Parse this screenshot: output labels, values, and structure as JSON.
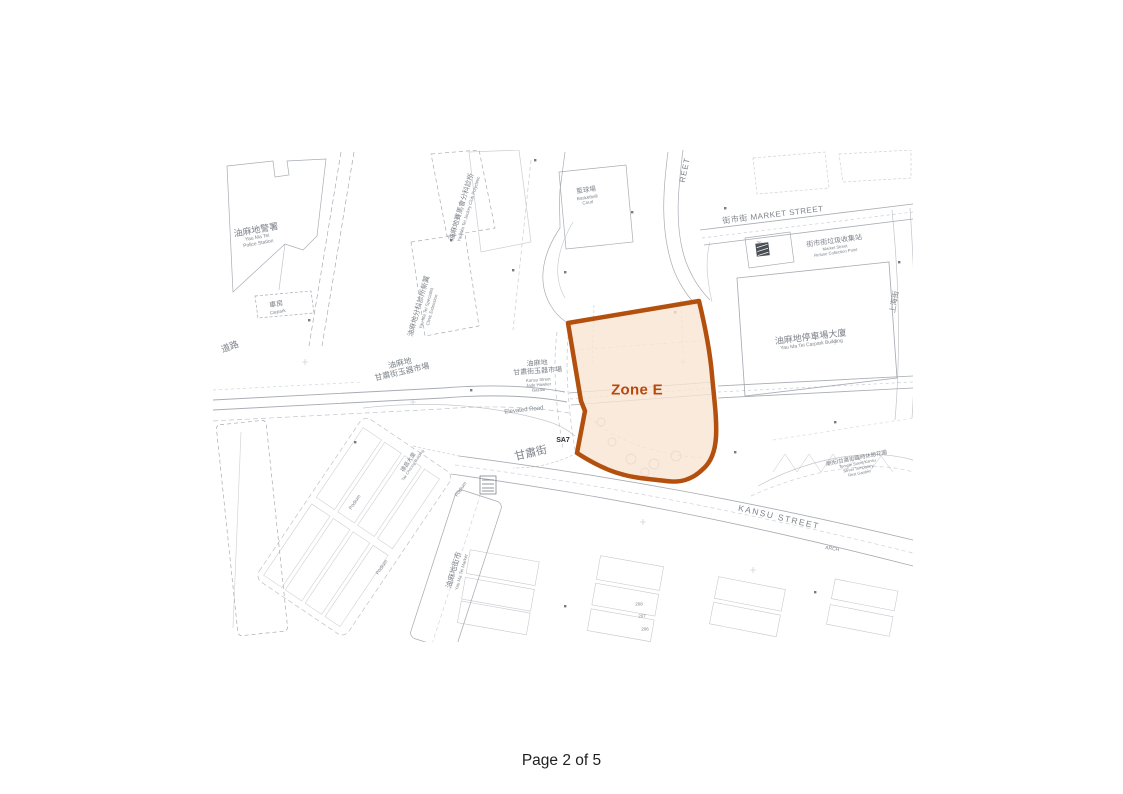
{
  "document": {
    "footer": "Page 2 of 5"
  },
  "map": {
    "zone": {
      "label": "Zone E",
      "fill": "#F7E4D2",
      "fill_opacity": 0.78,
      "border": "#B3500E",
      "label_color": "#B8490B",
      "label_x": 424,
      "label_y": 240
    },
    "ink": "#989da6",
    "labels": [
      {
        "id": "yau-ma-tei-police-station",
        "x": 44,
        "y": 86,
        "rot": -10,
        "lines": [
          {
            "t": "油麻地警署",
            "s": 9
          },
          {
            "t": "Yau Ma Tei",
            "s": 5
          },
          {
            "t": "Police Station",
            "s": 5
          }
        ]
      },
      {
        "id": "garage",
        "x": 64,
        "y": 158,
        "rot": -10,
        "lines": [
          {
            "t": "車房",
            "s": 7
          },
          {
            "t": "Carpark",
            "s": 4.5
          }
        ]
      },
      {
        "id": "road-name-partial",
        "x": 17,
        "y": 197,
        "rot": -20,
        "lines": [
          {
            "t": "道路",
            "s": 9
          }
        ]
      },
      {
        "id": "specialist-clinic-extension",
        "x": 212,
        "y": 158,
        "rot": -74,
        "lines": [
          {
            "t": "油麻地分科診所新翼",
            "s": 7
          },
          {
            "t": "Yau Ma Tei Specialist",
            "s": 4.5
          },
          {
            "t": "Clinic Extension",
            "s": 4.5
          }
        ]
      },
      {
        "id": "jockey-club-polyclinic",
        "x": 252,
        "y": 58,
        "rot": -73,
        "lines": [
          {
            "t": "油麻地賽馬會分科診所",
            "s": 7
          },
          {
            "t": "Yau Ma Tei Jockey Club Polyclinic",
            "s": 4.5
          }
        ]
      },
      {
        "id": "basketball-court",
        "x": 374,
        "y": 46,
        "rot": -8,
        "lines": [
          {
            "t": "籃球場",
            "s": 6.5
          },
          {
            "t": "Basketball",
            "s": 4.5
          },
          {
            "t": "Court",
            "s": 4.5
          }
        ]
      },
      {
        "id": "street-name-partial",
        "x": 472,
        "y": 20,
        "rot": -78,
        "lines": [
          {
            "t": "REET",
            "s": 8,
            "ls": 1
          }
        ]
      },
      {
        "id": "market-street",
        "x": 560,
        "y": 65,
        "rot": -7,
        "lines": [
          {
            "t": "街市街  MARKET STREET",
            "s": 8,
            "ls": 0.5
          }
        ]
      },
      {
        "id": "refuse-collection-point",
        "x": 622,
        "y": 97,
        "rot": -8,
        "lines": [
          {
            "t": "街市街垃圾收集站",
            "s": 7
          },
          {
            "t": "Market Street",
            "s": 4.2
          },
          {
            "t": "Refuse Collection Point",
            "s": 4.2
          }
        ]
      },
      {
        "id": "number-70",
        "x": 546,
        "y": 93,
        "rot": 0,
        "lines": [
          {
            "t": "70",
            "s": 4.5
          }
        ]
      },
      {
        "id": "carpark-building",
        "x": 598,
        "y": 190,
        "rot": -7,
        "lines": [
          {
            "t": "油麻地停車場大廈",
            "s": 9
          },
          {
            "t": "Yau Ma Tei Carpark Building",
            "s": 5
          }
        ]
      },
      {
        "id": "shanghai-street",
        "x": 682,
        "y": 152,
        "rot": -80,
        "lines": [
          {
            "t": "上海街",
            "s": 7.5
          }
        ]
      },
      {
        "id": "jade-market-cn",
        "x": 188,
        "y": 218,
        "rot": -13,
        "lines": [
          {
            "t": "油麻地",
            "s": 8
          },
          {
            "t": "甘肅街玉器市場",
            "s": 8
          }
        ]
      },
      {
        "id": "jade-hawker-bazaar",
        "x": 325,
        "y": 226,
        "rot": -4,
        "lines": [
          {
            "t": "油麻地",
            "s": 7
          },
          {
            "t": "甘肅街玉器市場",
            "s": 7
          },
          {
            "t": "Kansu Street",
            "s": 4.3
          },
          {
            "t": "Jade Hawker",
            "s": 4.3
          },
          {
            "t": "Bazaar",
            "s": 4.3
          }
        ]
      },
      {
        "id": "elevated-road",
        "x": 311,
        "y": 261,
        "rot": -6,
        "lines": [
          {
            "t": "Elevated Road",
            "s": 6
          }
        ]
      },
      {
        "id": "sa7-marker",
        "x": 350,
        "y": 291,
        "rot": 0,
        "lines": [
          {
            "t": "SA7",
            "s": 7,
            "b": true,
            "c": "#2a2d31"
          }
        ]
      },
      {
        "id": "kansu-street-cn",
        "x": 318,
        "y": 304,
        "rot": -13,
        "lines": [
          {
            "t": "甘肅街",
            "s": 11
          }
        ]
      },
      {
        "id": "kansu-street-en",
        "x": 566,
        "y": 367,
        "rot": 13,
        "lines": [
          {
            "t": "KANSU STREET",
            "s": 8.5,
            "ls": 1.5
          }
        ]
      },
      {
        "id": "rest-garden",
        "x": 645,
        "y": 316,
        "rot": -11,
        "lines": [
          {
            "t": "廟街/甘肅街臨時休憩花園",
            "s": 5.5
          },
          {
            "t": "Temple Street/Kansu",
            "s": 4
          },
          {
            "t": "Street Temporary",
            "s": 4
          },
          {
            "t": "Rest Garden",
            "s": 4
          }
        ]
      },
      {
        "id": "yau-ma-tei-market",
        "x": 244,
        "y": 421,
        "rot": -74,
        "lines": [
          {
            "t": "油麻地街市",
            "s": 7.5
          },
          {
            "t": "Yau Ma Tei Market",
            "s": 4.5
          }
        ]
      },
      {
        "id": "tak-cheong-building",
        "x": 198,
        "y": 314,
        "rot": -56,
        "lines": [
          {
            "t": "德昌大廈",
            "s": 5.5
          },
          {
            "t": "Tak Cheong Building",
            "s": 4
          }
        ]
      },
      {
        "id": "podium-1",
        "x": 143,
        "y": 353,
        "rot": -56,
        "lines": [
          {
            "t": "Podium",
            "s": 5
          }
        ]
      },
      {
        "id": "podium-2",
        "x": 170,
        "y": 418,
        "rot": -56,
        "lines": [
          {
            "t": "Podium",
            "s": 5
          }
        ]
      },
      {
        "id": "podium-3",
        "x": 249,
        "y": 340,
        "rot": -56,
        "lines": [
          {
            "t": "Podium",
            "s": 5
          }
        ]
      },
      {
        "id": "arch",
        "x": 619,
        "y": 400,
        "rot": 10,
        "lines": [
          {
            "t": "ARCH",
            "s": 5
          }
        ]
      },
      {
        "id": "number-208",
        "x": 426,
        "y": 454,
        "rot": 0,
        "lines": [
          {
            "t": "208",
            "s": 4.5
          }
        ]
      },
      {
        "id": "number-207",
        "x": 429,
        "y": 466,
        "rot": 0,
        "lines": [
          {
            "t": "207",
            "s": 4.5
          }
        ]
      },
      {
        "id": "number-206",
        "x": 432,
        "y": 479,
        "rot": 0,
        "lines": [
          {
            "t": "206",
            "s": 4.5
          }
        ]
      }
    ]
  }
}
